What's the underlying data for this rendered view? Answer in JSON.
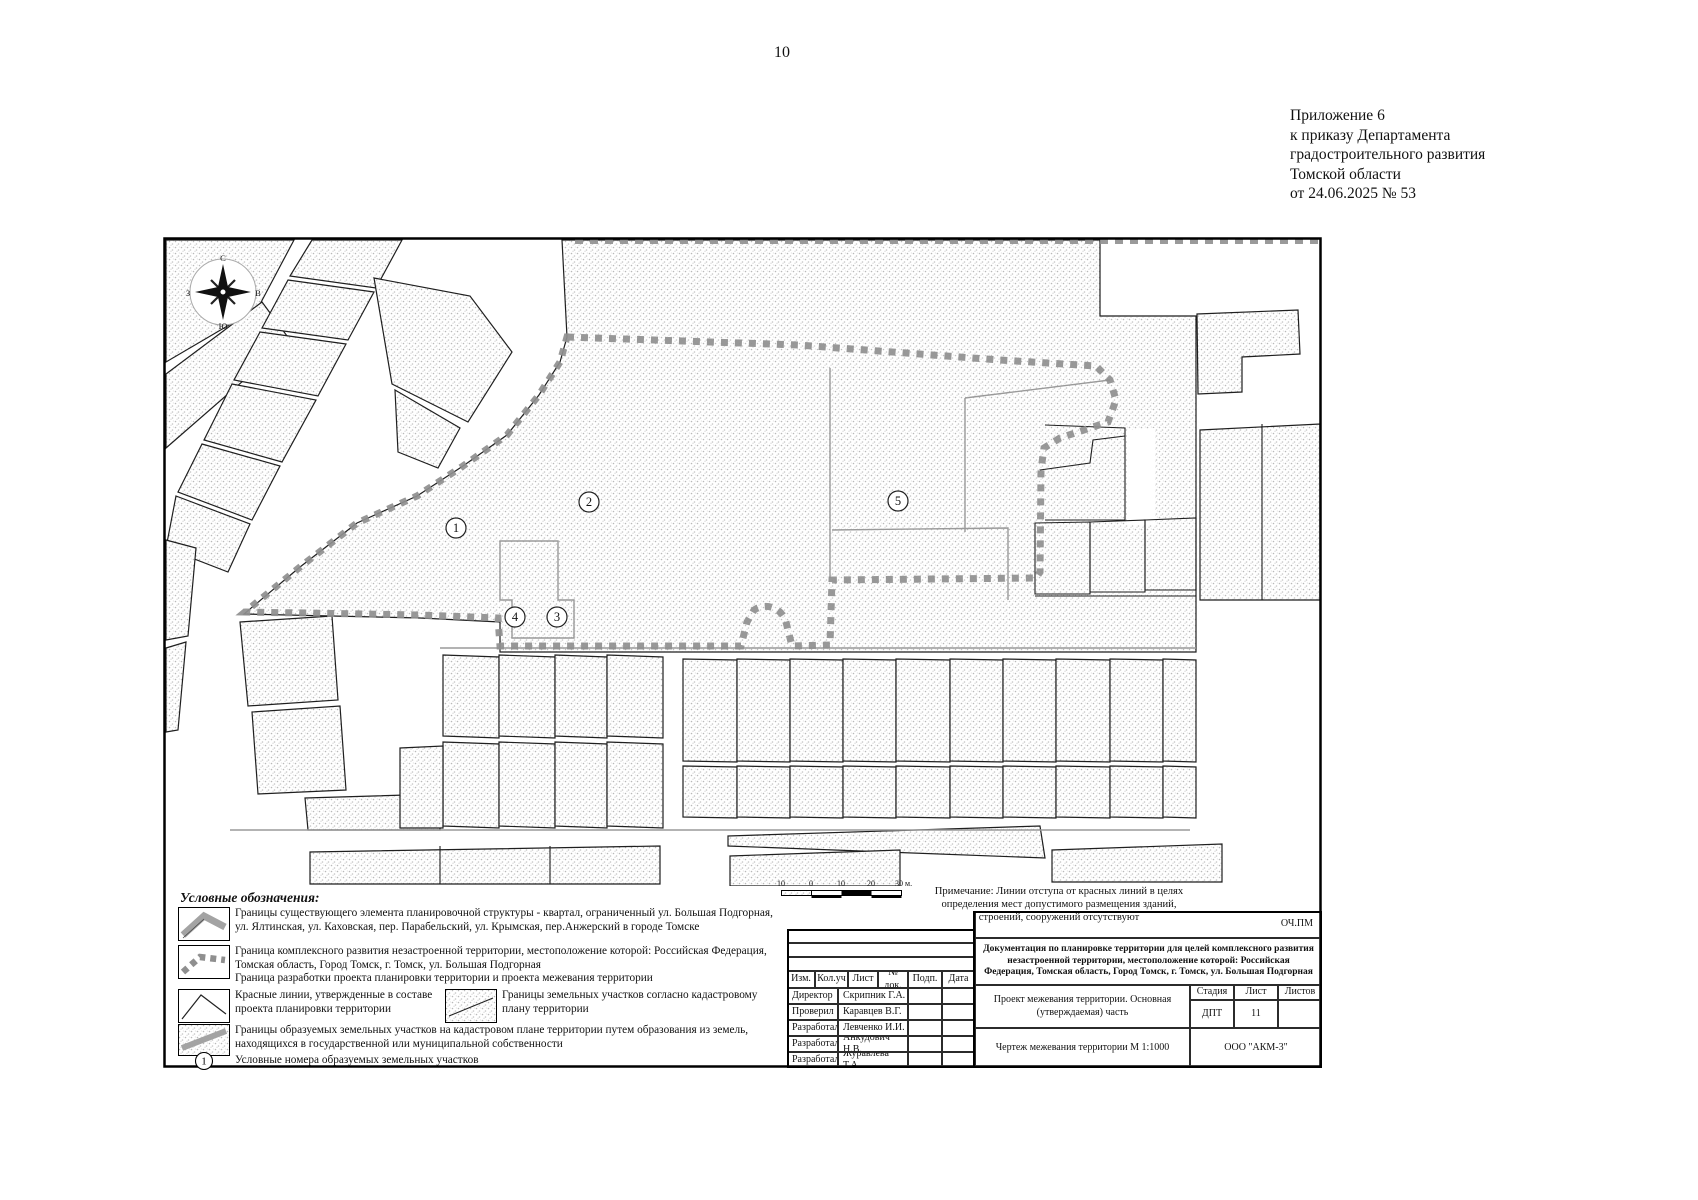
{
  "page": {
    "number": "10"
  },
  "appendix_note": {
    "lines": [
      "Приложение 6",
      "к приказу Департамента",
      "градостроительного развития",
      "Томской области",
      "от 24.06.2025 № 53"
    ]
  },
  "map": {
    "parcel_numbers": [
      "1",
      "2",
      "3",
      "4",
      "5"
    ],
    "compass": {
      "n": "С",
      "e": "В",
      "s": "Ю",
      "w": "З"
    }
  },
  "scale_bar": {
    "labels": [
      "10",
      "0",
      "10",
      "20",
      "30 м."
    ]
  },
  "note": {
    "text": "Примечание: Линии отступа от красных линий в целях определения мест допустимого размещения зданий, строений, сооружений отсутствуют"
  },
  "legend": {
    "title": "Условные обозначения:",
    "items": [
      {
        "symbol": "existing-block-boundary",
        "text": "Границы существующего элемента планировочной структуры - квартал, ограниченный ул. Большая Подгорная, ул. Ялтинская, ул. Каховская, пер. Парабельский, ул. Крымская, пер.Анжерский в городе Томске"
      },
      {
        "symbol": "development-boundary",
        "text": "Граница комплексного развития незастроенной территории, местоположение которой: Российская Федерация, Томская область, Город Томск, г. Томск, ул. Большая Подгорная",
        "text2": "Граница разработки проекта планировки территории и проекта межевания территории"
      },
      {
        "symbol": "red-lines",
        "text": "Красные линии, утвержденные в составе проекта планировки территории"
      },
      {
        "symbol": "cadastral-parcels",
        "text": "Границы земельных участков согласно кадастровому плану территории"
      },
      {
        "symbol": "formed-parcels",
        "text": "Границы образуемых земельных участков на кадастровом плане территории путем образования из земель, находящихся в государственной или муниципальной собственности"
      },
      {
        "symbol": "parcel-number",
        "text": "Условные номера образуемых земельных участков",
        "marker": "1"
      }
    ]
  },
  "title_block": {
    "code": "ОЧ.ПМ",
    "doc_title": "Документация по планировке территории для целей комплексного развития незастроенной территории, местоположение которой: Российская Федерация, Томская область, Город Томск, г. Томск, ул. Большая Подгорная",
    "columns": [
      "Изм.",
      "Кол.уч",
      "Лист",
      "№ док.",
      "Подп.",
      "Дата"
    ],
    "signatures": [
      {
        "role": "Директор",
        "name": "Скрипник Г.А."
      },
      {
        "role": "Проверил",
        "name": "Каравцев В.Г."
      },
      {
        "role": "Разработал",
        "name": "Левченко И.И."
      },
      {
        "role": "Разработал",
        "name": "Анкудович Н.В."
      },
      {
        "role": "Разработал",
        "name": "Журавлева Т.А."
      }
    ],
    "project": "Проект межевания территории. Основная (утверждаемая) часть",
    "drawing": "Чертеж межевания территории М 1:1000",
    "stage_label": "Стадия",
    "sheet_label": "Лист",
    "sheets_label": "Листов",
    "stage": "ДПТ",
    "sheet": "11",
    "sheets": "",
    "company": "ООО \"АКМ-3\""
  },
  "colors": {
    "boundary_dash": "#8f8f8f",
    "parcel_outline": "#1f1f1f",
    "stipple_dot": "#bdbdbd",
    "thin_line": "#9a9a9a"
  }
}
